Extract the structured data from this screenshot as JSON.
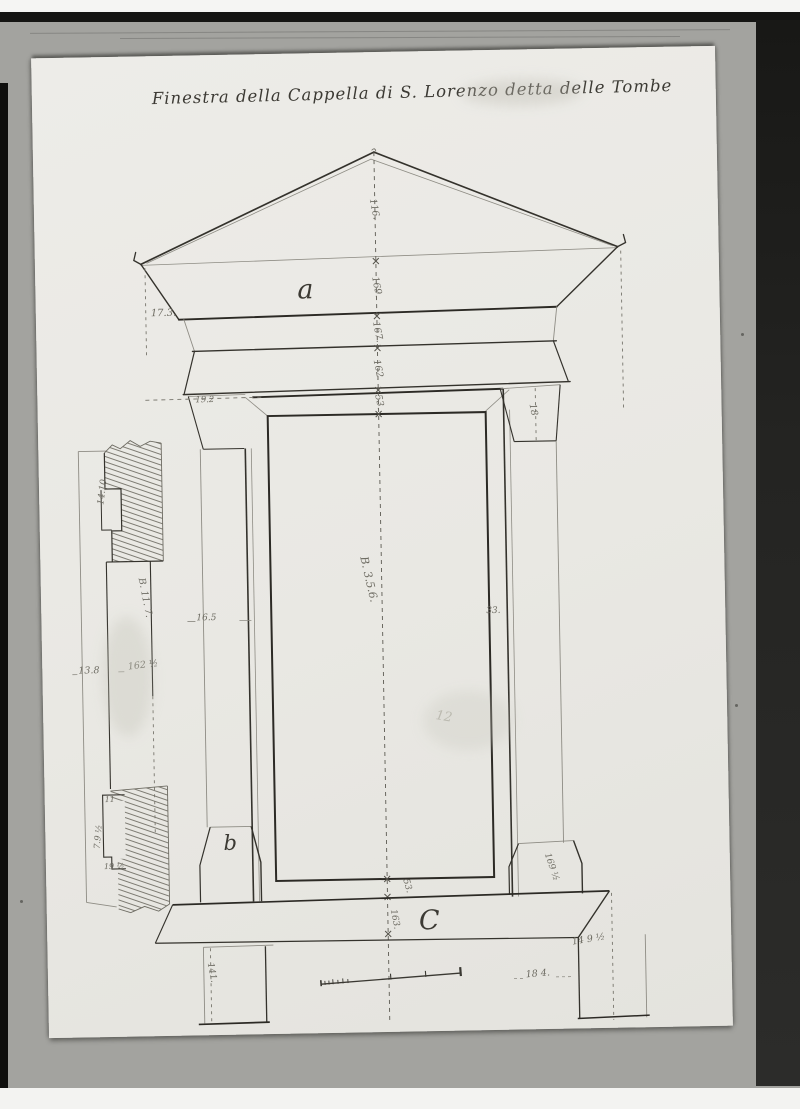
{
  "photo": {
    "mount_color": "#a3a39f",
    "paper_color": "#eae9e4",
    "ink_color": "#3a3832",
    "pencil_color": "#6e6c63"
  },
  "drawing": {
    "title": "Finestra della Cappella di S. Lorenzo detta delle Tombe",
    "labels": {
      "pediment": "a",
      "base": "b",
      "sill": "C"
    },
    "centerline": [
      "116.",
      "169.",
      "167.",
      "162.",
      "53.",
      "53.",
      "163."
    ],
    "dims": {
      "cornice_left": "17.3.",
      "capital_left": "19.2",
      "capital_right": "18",
      "shaft_left": "16.5",
      "shaft_right": "33.",
      "aperture_height": "B. 3.5.6.",
      "aperture_faint": "12",
      "base_right": "169 ½",
      "sill_right": "14 9 ½",
      "plinth_left": "141.",
      "plinth_right": "18 4."
    },
    "detail": {
      "top": "14.10",
      "side": "B. 11. 7.",
      "width": "13.8",
      "height": "162 ½",
      "step": "11",
      "lower": "7.9 ½",
      "bottom": "19 ½"
    }
  }
}
